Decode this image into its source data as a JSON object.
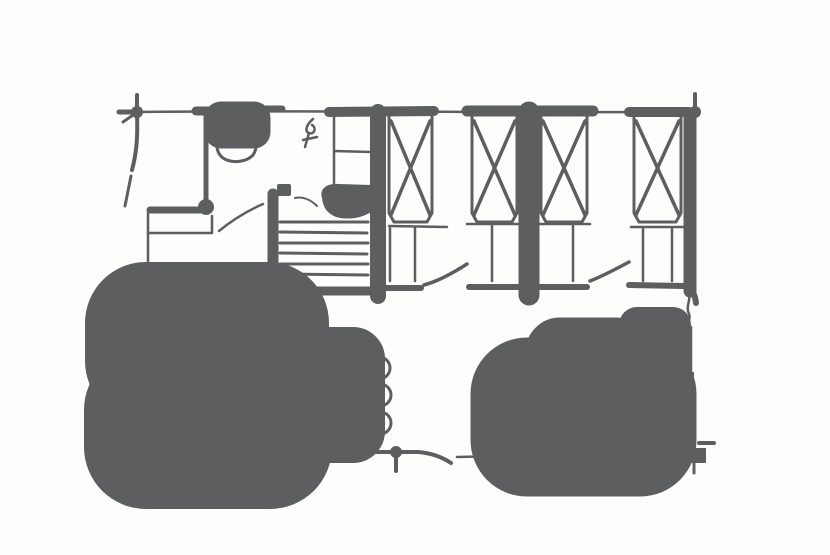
{
  "figure": {
    "kind": "hand-drawn-floor-plan-sketch",
    "description": "pencil sketch of a cabin floor plan: bathroom, hall with stairs, four crossed beds along top, kitchen counters, dining table with six chairs, L-shaped sofa with coffee table",
    "colors": {
      "ink": "#5d5e60",
      "background": "#fdfdfc"
    },
    "canvas": {
      "width": 830,
      "height": 555
    }
  },
  "elements": [
    {
      "n": "top-wall-line",
      "k": "path",
      "d": "M137,112 C300,110 520,113 696,112",
      "w": 2.5
    },
    {
      "n": "top-wall-thick-bathroom",
      "k": "line",
      "x1": 196,
      "y1": 111,
      "x2": 251,
      "y2": 111,
      "w": 9
    },
    {
      "n": "top-wall-dash",
      "k": "line",
      "x1": 262,
      "y1": 109,
      "x2": 282,
      "y2": 109,
      "w": 7
    },
    {
      "n": "top-wall-thick-hall",
      "k": "line",
      "x1": 329,
      "y1": 112,
      "x2": 434,
      "y2": 111,
      "w": 10
    },
    {
      "n": "top-wall-thick-middle",
      "k": "line",
      "x1": 467,
      "y1": 111,
      "x2": 593,
      "y2": 111,
      "w": 11
    },
    {
      "n": "top-wall-thick-right",
      "k": "line",
      "x1": 629,
      "y1": 112,
      "x2": 689,
      "y2": 112,
      "w": 10
    },
    {
      "n": "corner-top-left-tick-up",
      "k": "line",
      "x1": 137,
      "y1": 95,
      "x2": 137,
      "y2": 114,
      "w": 4
    },
    {
      "n": "corner-top-left-tick-left",
      "k": "line",
      "x1": 119,
      "y1": 112,
      "x2": 138,
      "y2": 112,
      "w": 5
    },
    {
      "n": "corner-top-left-tick-diagonal",
      "k": "line",
      "x1": 123,
      "y1": 122,
      "x2": 136,
      "y2": 113,
      "w": 3
    },
    {
      "n": "corner-top-left-blob",
      "k": "circle",
      "cx": 137,
      "cy": 112,
      "r": 6,
      "fill": true
    },
    {
      "n": "left-wall-upper",
      "k": "path",
      "d": "M137,114 C138,140 136,155 132,170",
      "w": 4
    },
    {
      "n": "left-wall-upper-curve",
      "k": "path",
      "d": "M131,176 C129,186 127,196 125,206",
      "w": 3
    },
    {
      "n": "corner-top-right-blob",
      "k": "circle",
      "cx": 695,
      "cy": 112,
      "r": 6,
      "fill": true
    },
    {
      "n": "corner-top-right-tick-up",
      "k": "line",
      "x1": 695,
      "y1": 94,
      "x2": 695,
      "y2": 113,
      "w": 4
    },
    {
      "n": "right-wall-upper",
      "k": "line",
      "x1": 690,
      "y1": 114,
      "x2": 690,
      "y2": 291,
      "w": 13
    },
    {
      "n": "right-wall-squiggle",
      "k": "path",
      "d": "M688,292 C692,300 685,306 689,314 C691,319 687,322 689,327",
      "w": 2.5
    },
    {
      "n": "right-wall-lower",
      "k": "line",
      "x1": 691,
      "y1": 327,
      "x2": 691,
      "y2": 434,
      "w": 2.5
    },
    {
      "n": "interior-wall-dash-1",
      "k": "line",
      "x1": 377,
      "y1": 288,
      "x2": 421,
      "y2": 288,
      "w": 6
    },
    {
      "n": "door-leaf-1",
      "k": "path",
      "d": "M424,285 C439,281 453,273 467,264",
      "w": 3.5
    },
    {
      "n": "interior-wall-dash-2",
      "k": "line",
      "x1": 469,
      "y1": 287,
      "x2": 587,
      "y2": 287,
      "w": 6
    },
    {
      "n": "door-leaf-2",
      "k": "path",
      "d": "M590,281 C603,276 616,269 629,262",
      "w": 3.5
    },
    {
      "n": "interior-wall-dash-3",
      "k": "path",
      "d": "M629,285 L685,286 C692,288 695,294 696,303",
      "w": 6
    },
    {
      "n": "bedroom-middle-wall",
      "k": "line",
      "x1": 529,
      "y1": 112,
      "x2": 529,
      "y2": 295,
      "w": 21
    },
    {
      "n": "bedroom-left-wall",
      "k": "line",
      "x1": 378,
      "y1": 112,
      "x2": 378,
      "y2": 296,
      "w": 16
    },
    {
      "n": "bottom-wall",
      "k": "path",
      "d": "M141,452 L418,452 C431,453 442,457 451,463",
      "w": 4
    },
    {
      "n": "bottom-wall-segment",
      "k": "line",
      "x1": 457,
      "y1": 457,
      "x2": 502,
      "y2": 456,
      "w": 2.5
    },
    {
      "n": "corner-bottom-left-blob",
      "k": "circle",
      "cx": 143,
      "cy": 452,
      "r": 7,
      "fill": true
    },
    {
      "n": "corner-bottom-left-tick-down",
      "k": "line",
      "x1": 143,
      "y1": 453,
      "x2": 143,
      "y2": 482,
      "w": 4
    },
    {
      "n": "corner-bottom-left-tick-left",
      "k": "line",
      "x1": 123,
      "y1": 452,
      "x2": 143,
      "y2": 452,
      "w": 4
    },
    {
      "n": "bottom-wall-post-blob",
      "k": "circle",
      "cx": 396,
      "cy": 452,
      "r": 6,
      "fill": true
    },
    {
      "n": "bottom-wall-post-tick",
      "k": "line",
      "x1": 396,
      "y1": 453,
      "x2": 396,
      "y2": 471,
      "w": 4
    },
    {
      "n": "bathroom-wall",
      "k": "line",
      "x1": 206,
      "y1": 114,
      "x2": 206,
      "y2": 201,
      "w": 5
    },
    {
      "n": "bathroom-wall-blob",
      "k": "circle",
      "cx": 206,
      "cy": 207,
      "r": 8,
      "fill": true
    },
    {
      "n": "toilet-tank",
      "k": "rect",
      "x": 221,
      "y": 118,
      "w": 33,
      "h": 14,
      "sw": 3
    },
    {
      "n": "toilet-bowl",
      "k": "path",
      "d": "M222,131 C215,139 215,152 223,158 C232,164 247,162 253,155 C258,148 257,137 251,130",
      "w": 3
    },
    {
      "n": "toilet-flush-mark",
      "k": "path",
      "d": "M254,127 l10,3 l-2,9",
      "w": 2.5
    },
    {
      "n": "vanity-counter-top",
      "k": "line",
      "x1": 150,
      "y1": 210,
      "x2": 207,
      "y2": 210,
      "w": 7
    },
    {
      "n": "vanity-outline",
      "k": "path",
      "d": "M212,216 L212,233 L149,233",
      "w": 2.5
    },
    {
      "n": "bathroom-left-wall",
      "k": "path",
      "d": "M148,213 L148,267 C147,281 143,293 136,303",
      "w": 2.5
    },
    {
      "n": "bathroom-door-arc",
      "k": "path",
      "d": "M219,231 C231,221 247,211 263,204",
      "w": 2.5
    },
    {
      "n": "hall-symbol",
      "k": "path",
      "d": "M313,119 C307,124 304,131 309,133 C314,135 317,128 312,125 M309,133 L305,147 M303,140 L317,137",
      "w": 2.5
    },
    {
      "n": "closet-outline",
      "k": "path",
      "d": "M334,115 L334,183 M334,151 L371,152",
      "w": 2.5
    },
    {
      "n": "dark-fixture-blob",
      "k": "path",
      "d": "M322,198 C319,188 328,183 339,184 L371,185 L371,212 C361,219 342,221 332,215 C325,211 323,205 322,198 Z",
      "fill": true
    },
    {
      "n": "small-dark-dot",
      "k": "rect",
      "x": 277,
      "y": 184,
      "w": 14,
      "h": 12,
      "rx": 2,
      "fill": true
    },
    {
      "n": "dot-curve",
      "k": "path",
      "d": "M295,198 C303,196 311,200 317,206",
      "w": 2
    },
    {
      "n": "stairs-left-rail",
      "k": "line",
      "x1": 273,
      "y1": 194,
      "x2": 273,
      "y2": 295,
      "w": 11
    },
    {
      "n": "stair-tread-1",
      "k": "line",
      "x1": 280,
      "y1": 222,
      "x2": 368,
      "y2": 222,
      "w": 3
    },
    {
      "n": "stair-tread-2",
      "k": "line",
      "x1": 280,
      "y1": 232,
      "x2": 367,
      "y2": 233,
      "w": 3
    },
    {
      "n": "stair-tread-3",
      "k": "line",
      "x1": 280,
      "y1": 243,
      "x2": 368,
      "y2": 243,
      "w": 3
    },
    {
      "n": "stair-tread-4",
      "k": "line",
      "x1": 280,
      "y1": 253,
      "x2": 367,
      "y2": 254,
      "w": 3
    },
    {
      "n": "stair-tread-5",
      "k": "line",
      "x1": 280,
      "y1": 264,
      "x2": 368,
      "y2": 264,
      "w": 3
    },
    {
      "n": "stair-tread-6",
      "k": "line",
      "x1": 280,
      "y1": 274,
      "x2": 368,
      "y2": 275,
      "w": 3
    },
    {
      "n": "stairs-bottom-bar",
      "k": "line",
      "x1": 267,
      "y1": 291,
      "x2": 381,
      "y2": 291,
      "w": 9
    },
    {
      "n": "bed-1-outline",
      "k": "path",
      "d": "M389,114 L389,213 L394,222 L427,222 L432,213 L432,114",
      "w": 3
    },
    {
      "n": "bed-1-cross",
      "k": "path",
      "d": "M391,121 L430,215 M430,121 L391,215",
      "w": 3.5
    },
    {
      "n": "bed-1-foot-line",
      "k": "line",
      "x1": 389,
      "y1": 226,
      "x2": 447,
      "y2": 227,
      "w": 2.5
    },
    {
      "n": "bed-1-step",
      "k": "path",
      "d": "M390,228 L390,281 M415,227 L415,281",
      "w": 2.5
    },
    {
      "n": "bed-2-outline",
      "k": "path",
      "d": "M472,114 L472,213 L477,222 L512,222 L517,213 L517,114",
      "w": 3
    },
    {
      "n": "bed-2-cross",
      "k": "path",
      "d": "M474,121 L515,215 M515,121 L474,215",
      "w": 3.5
    },
    {
      "n": "bed-2-foot-line",
      "k": "line",
      "x1": 467,
      "y1": 224,
      "x2": 519,
      "y2": 224,
      "w": 2.5
    },
    {
      "n": "bed-2-step",
      "k": "line",
      "x1": 492,
      "y1": 226,
      "x2": 492,
      "y2": 281,
      "w": 2.5
    },
    {
      "n": "bed-3-outline",
      "k": "path",
      "d": "M541,114 L541,213 L546,222 L582,222 L587,213 L587,114",
      "w": 3
    },
    {
      "n": "bed-3-cross",
      "k": "path",
      "d": "M543,121 L585,215 M585,121 L543,215",
      "w": 3.5
    },
    {
      "n": "bed-3-foot-line",
      "k": "line",
      "x1": 538,
      "y1": 224,
      "x2": 590,
      "y2": 224,
      "w": 2.5
    },
    {
      "n": "bed-3-step",
      "k": "line",
      "x1": 573,
      "y1": 226,
      "x2": 573,
      "y2": 281,
      "w": 2.5
    },
    {
      "n": "bed-4-outline",
      "k": "path",
      "d": "M634,114 L634,213 L639,222 L676,222 L681,213 L681,114",
      "w": 3
    },
    {
      "n": "bed-4-cross",
      "k": "path",
      "d": "M636,121 L679,215 M679,121 L636,215",
      "w": 3.5
    },
    {
      "n": "bed-4-foot-line",
      "k": "line",
      "x1": 631,
      "y1": 227,
      "x2": 684,
      "y2": 227,
      "w": 2.5
    },
    {
      "n": "bed-4-step",
      "k": "path",
      "d": "M643,229 L643,281 M672,229 L672,281",
      "w": 2.5
    },
    {
      "n": "kitchen-counter-top-row",
      "k": "rect",
      "x": 146,
      "y": 323,
      "w": 122,
      "h": 38,
      "sw": 3
    },
    {
      "n": "kitchen-top-divider-1",
      "k": "line",
      "x1": 200,
      "y1": 325,
      "x2": 200,
      "y2": 360,
      "w": 2.5
    },
    {
      "n": "kitchen-top-divider-2",
      "k": "line",
      "x1": 236,
      "y1": 324,
      "x2": 236,
      "y2": 361,
      "w": 2.5
    },
    {
      "n": "kitchen-top-overshoot",
      "k": "line",
      "x1": 137,
      "y1": 323,
      "x2": 147,
      "y2": 323,
      "w": 2
    },
    {
      "n": "kitchen-counter-bottom-row",
      "k": "rect",
      "x": 146,
      "y": 410,
      "w": 124,
      "h": 37,
      "sw": 3
    },
    {
      "n": "kitchen-bottom-divider-1",
      "k": "line",
      "x1": 177,
      "y1": 412,
      "x2": 177,
      "y2": 446,
      "w": 2.5
    },
    {
      "n": "kitchen-bottom-divider-2",
      "k": "line",
      "x1": 208,
      "y1": 411,
      "x2": 208,
      "y2": 447,
      "w": 2.5
    },
    {
      "n": "living-left-wall",
      "k": "line",
      "x1": 146,
      "y1": 325,
      "x2": 146,
      "y2": 452,
      "w": 3
    },
    {
      "n": "dining-table",
      "k": "rect",
      "x": 310,
      "y": 352,
      "w": 50,
      "h": 86,
      "rx": 7,
      "sw": 3.5
    },
    {
      "n": "dining-chair-left-1",
      "k": "circle",
      "cx": 292,
      "cy": 369,
      "r": 11,
      "sw": 3
    },
    {
      "n": "dining-chair-left-2",
      "k": "circle",
      "cx": 291,
      "cy": 396,
      "r": 11,
      "sw": 3
    },
    {
      "n": "dining-chair-left-3",
      "k": "circle",
      "cx": 293,
      "cy": 423,
      "r": 11,
      "sw": 3
    },
    {
      "n": "dining-chair-right-1",
      "k": "circle",
      "cx": 379,
      "cy": 368,
      "r": 11,
      "sw": 3
    },
    {
      "n": "dining-chair-right-2",
      "k": "circle",
      "cx": 380,
      "cy": 395,
      "r": 11,
      "sw": 3
    },
    {
      "n": "dining-chair-right-3",
      "k": "circle",
      "cx": 380,
      "cy": 423,
      "r": 11,
      "sw": 3
    },
    {
      "n": "coffee-table",
      "k": "rect",
      "x": 557,
      "y": 349,
      "w": 63,
      "h": 34,
      "rx": 3,
      "sw": 3.5
    },
    {
      "n": "sofa-long-section",
      "k": "rect",
      "x": 527,
      "y": 394,
      "w": 113,
      "h": 46,
      "sw": 3
    },
    {
      "n": "sofa-long-mid-line",
      "k": "line",
      "x1": 527,
      "y1": 427,
      "x2": 640,
      "y2": 427,
      "w": 2.5
    },
    {
      "n": "sofa-long-divider-1",
      "k": "line",
      "x1": 565,
      "y1": 395,
      "x2": 565,
      "y2": 427,
      "w": 2.5
    },
    {
      "n": "sofa-long-divider-2",
      "k": "line",
      "x1": 603,
      "y1": 395,
      "x2": 603,
      "y2": 427,
      "w": 2.5
    },
    {
      "n": "sofa-back-shadow-bar",
      "k": "rect",
      "x": 540,
      "y": 432,
      "w": 137,
      "h": 17,
      "fill": true
    },
    {
      "n": "sofa-corner-section",
      "k": "rect",
      "x": 637,
      "y": 325,
      "w": 36,
      "h": 118,
      "sw": 3
    },
    {
      "n": "sofa-corner-divider-1",
      "k": "line",
      "x1": 638,
      "y1": 360,
      "x2": 672,
      "y2": 360,
      "w": 2.5
    },
    {
      "n": "sofa-corner-divider-2",
      "k": "line",
      "x1": 638,
      "y1": 394,
      "x2": 672,
      "y2": 394,
      "w": 2.5
    },
    {
      "n": "right-wall-mark",
      "k": "rect",
      "x": 677,
      "y": 326,
      "w": 12,
      "h": 26,
      "fill": true
    },
    {
      "n": "right-wall-mark-tick",
      "k": "line",
      "x1": 663,
      "y1": 351,
      "x2": 678,
      "y2": 351,
      "w": 3.5
    },
    {
      "n": "right-wall-shadow-bar",
      "k": "rect",
      "x": 677,
      "y": 372,
      "w": 17,
      "h": 86,
      "fill": true
    },
    {
      "n": "corner-bottom-right-foot",
      "k": "path",
      "d": "M676,448 L706,448 L706,463 L683,463 Z",
      "fill": true
    },
    {
      "n": "corner-bottom-right-tick",
      "k": "line",
      "x1": 699,
      "y1": 443,
      "x2": 714,
      "y2": 443,
      "w": 4
    },
    {
      "n": "corner-bottom-right-tick-down",
      "k": "line",
      "x1": 694,
      "y1": 463,
      "x2": 694,
      "y2": 473,
      "w": 3
    }
  ]
}
